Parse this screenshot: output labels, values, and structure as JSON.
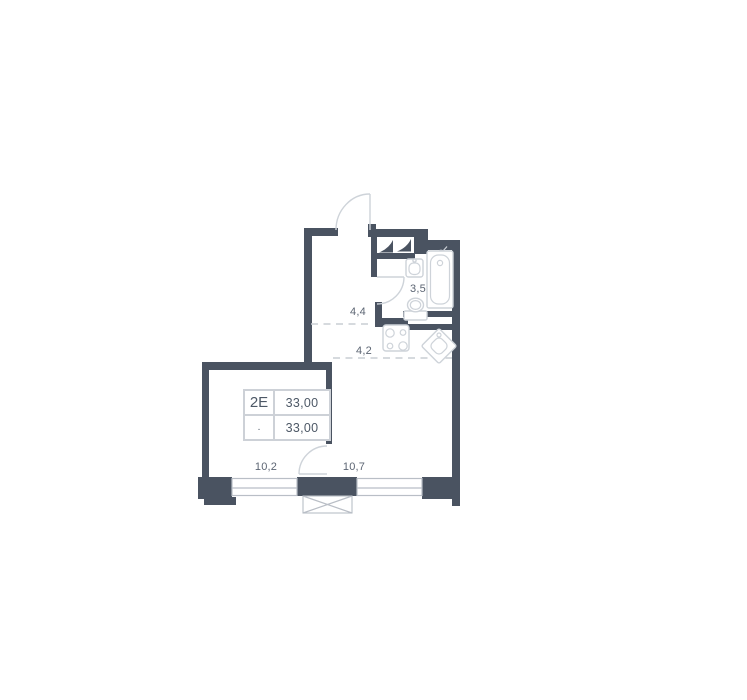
{
  "floorplan": {
    "unit": {
      "type_label": "2E",
      "area_total": "33,00",
      "area_living": "33,00",
      "dot_mark": "."
    },
    "rooms": {
      "bathroom": {
        "area": "3,5"
      },
      "hallway": {
        "area": "4,4"
      },
      "kitchen": {
        "area": "4,2"
      },
      "room_left": {
        "area": "10,2"
      },
      "room_right": {
        "area": "10,7"
      }
    },
    "icons": [
      "entrance-door-arc-icon",
      "bathroom-door-arc-icon",
      "room-door-arc-icon",
      "wardrobe-icon",
      "bath-sink-icon",
      "shower-head-icon",
      "bathtub-icon",
      "toilet-icon",
      "stove-icon",
      "kitchen-sink-icon",
      "vent-shaft-icon",
      "window-icon"
    ],
    "colors": {
      "wall": "#4a5361",
      "label": "#5c6573",
      "fixture": "#ced3d9",
      "dashed": "#c9cdd3",
      "window": "#b9bec6",
      "tableBorder": "#cdd1d7",
      "unitText": "#4d5866"
    }
  }
}
